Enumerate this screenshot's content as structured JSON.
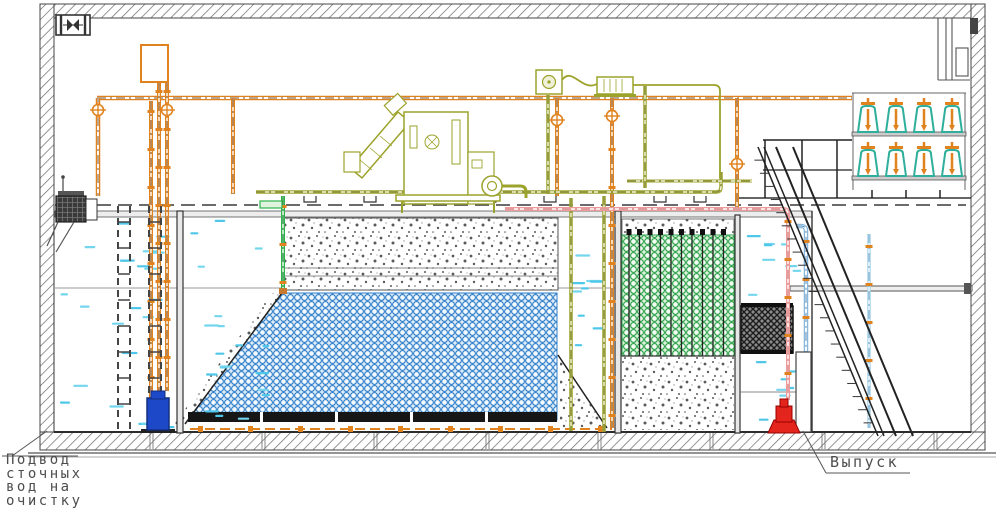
{
  "labels": {
    "inlet_line1": "Подвод",
    "inlet_line2": "сточных",
    "inlet_line3": "вод на",
    "inlet_line4": "очистку",
    "outlet": "Выпуск"
  },
  "palette": {
    "pipe_orange": "#E0821E",
    "pipe_olive": "#9CA32B",
    "pipe_green": "#2DB34A",
    "pipe_pink": "#EF9A9A",
    "pipe_blue": "#86B8E0",
    "pipe_light_blue": "#A8D4EC",
    "water_mark_cyan": "#4FC7E8",
    "diffuser_teal": "#2FAE9B",
    "pump_blue": "#1D49C8",
    "pump_red": "#E3251E",
    "line_dark": "#3A3A3A"
  },
  "components": [
    "ventilation-fan-icon",
    "exhaust-duct",
    "building-shell",
    "water-level-line",
    "inlet-screen-equipment",
    "guide-rails",
    "inlet-pump-blue",
    "dosing-tank",
    "air-header-pipe",
    "air-valves",
    "screw-press-equipment",
    "blower-units",
    "gravel-layer",
    "media-bed-blue",
    "media-bed-green",
    "aeration-grid",
    "clarifier-baffle",
    "outlet-chamber",
    "outlet-pump-red",
    "sludge-pipe-pink",
    "outlet-pipe-blue",
    "recirculation-pipe-green",
    "diffuser-rack-upper",
    "diffuser-rack-lower",
    "platform-railing",
    "staircase",
    "floor-slab"
  ]
}
